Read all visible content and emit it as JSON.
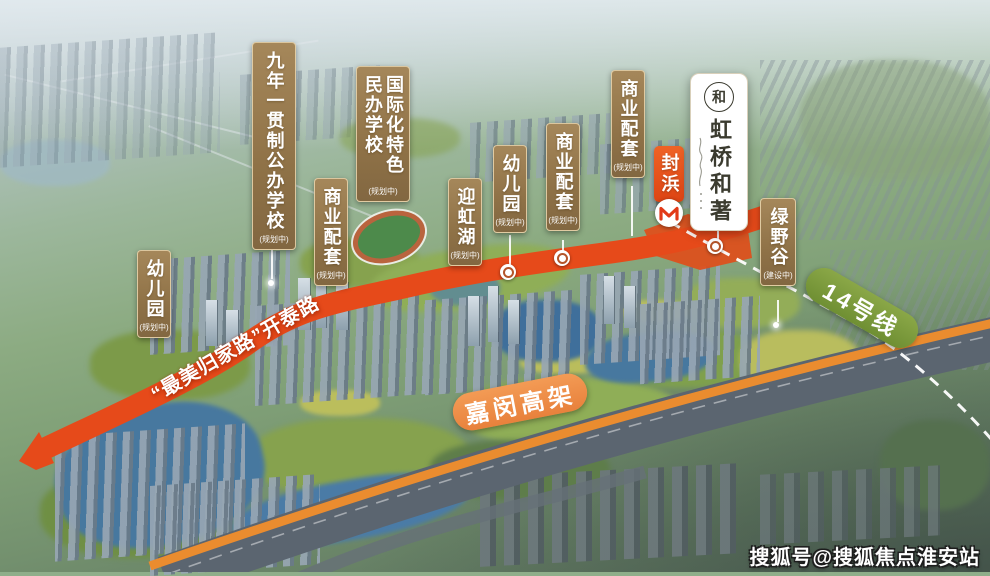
{
  "poi_labels": [
    {
      "id": "public-school",
      "text": "九年一贯制公办学校",
      "sub": "(规划中)"
    },
    {
      "id": "private-school",
      "text": "国际化特色民办学校",
      "sub": "(规划中)"
    },
    {
      "id": "commercial-1",
      "text": "商业配套",
      "sub": "(规划中)"
    },
    {
      "id": "kindergarten-1",
      "text": "幼儿园",
      "sub": "(规划中)"
    },
    {
      "id": "yinghong-lake",
      "text": "迎虹湖",
      "sub": "(规划中)"
    },
    {
      "id": "kindergarten-2",
      "text": "幼儿园",
      "sub": "(规划中)"
    },
    {
      "id": "commercial-2",
      "text": "商业配套",
      "sub": "(规划中)"
    },
    {
      "id": "commercial-3",
      "text": "商业配套",
      "sub": "(规划中)"
    },
    {
      "id": "green-valley",
      "text": "绿野谷",
      "sub": "(建设中)"
    }
  ],
  "project": {
    "name": "虹桥和著",
    "logo_char": "和"
  },
  "station": {
    "name": "封浜"
  },
  "transit_banner": {
    "text": "14号线"
  },
  "highway_banner": {
    "text": "嘉闵高架"
  },
  "road_label": {
    "text": "“最美归家路”开泰路"
  },
  "watermark": {
    "text": "搜狐号@搜狐焦点淮安站"
  },
  "colors": {
    "label_gold": "#97794c",
    "road_red": "#e64a1a",
    "site_red": "#e04e1a",
    "station_red": "#e3501f",
    "line14_green": "#7a9a3a",
    "jiamin_orange": "#ef914c",
    "highway_stripe": "#ea8c2f",
    "card_bg": "#ffffff",
    "card_ink": "#3b3b2f"
  }
}
